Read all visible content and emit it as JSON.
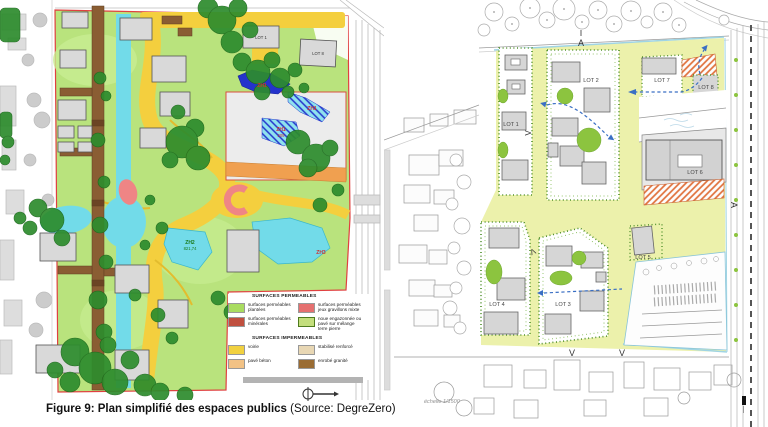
{
  "caption": {
    "title": "Figure 9: Plan simplifié des espaces publics",
    "source": " (Source: DegreZero)"
  },
  "left_map": {
    "lot_labels": {
      "lot1": "LOT 1",
      "lot8": "LOT 8"
    },
    "zone_labels": {
      "zh1_pond": "ZH1",
      "zh1_band": "ZH1",
      "zh1_inner": "ZH1",
      "zh1_inner_area": "209",
      "zh2": "ZH2",
      "zh2_area": "821,74",
      "zh3": "ZH3"
    },
    "legend": {
      "permeable_title": "SURFACES PERMEABLES",
      "permeable_items": [
        {
          "label": "surfaces perméables plantées",
          "color": "#a9dc60"
        },
        {
          "label": "surfaces perméables minérales",
          "color": "#c0503f"
        },
        {
          "label": "surfaces perméables jeux gravillons mixte",
          "color": "#e57070"
        },
        {
          "label": "noue engazonnée ou pavé sur mélange terre pierre",
          "color": "#c3de7c"
        }
      ],
      "impermeable_title": "SURFACES IMPERMEABLES",
      "impermeable_items": [
        {
          "label": "voirie",
          "color": "#f1d140"
        },
        {
          "label": "pavé béton",
          "color": "#f2c285"
        },
        {
          "label": "stabilisé renforcé",
          "color": "#e8d7b4"
        },
        {
          "label": "enrobé granité",
          "color": "#9a6c33"
        }
      ]
    }
  },
  "right_map": {
    "lot_labels": [
      {
        "label": "LOT 1"
      },
      {
        "label": "LOT 2"
      },
      {
        "label": "LOT 3"
      },
      {
        "label": "LOT 4"
      },
      {
        "label": "LOT 5"
      },
      {
        "label": "LOT 6"
      },
      {
        "label": "LOT 7"
      },
      {
        "label": "LOT 8"
      }
    ],
    "scale_text": "échelle 1/1500",
    "section_markers": {
      "top": "A",
      "side": "A",
      "bottom_a": "V",
      "bottom_b": "V",
      "lot1": "V",
      "lot4": "V"
    }
  },
  "colors": {
    "site_green": "#b9e37d",
    "path_yellow": "#f4cf3e",
    "water_cyan": "#72dbe9",
    "pond_blue": "#2433cc",
    "road_brown": "#8a5d33",
    "tree_green": "#2d8c2d",
    "site_pale": "#ecf1ab",
    "lawn_green": "#8cc43f",
    "orange_hatch": "#e0703a",
    "arrow_blue": "#3a6fc4",
    "boundary_red": "#e04040"
  }
}
